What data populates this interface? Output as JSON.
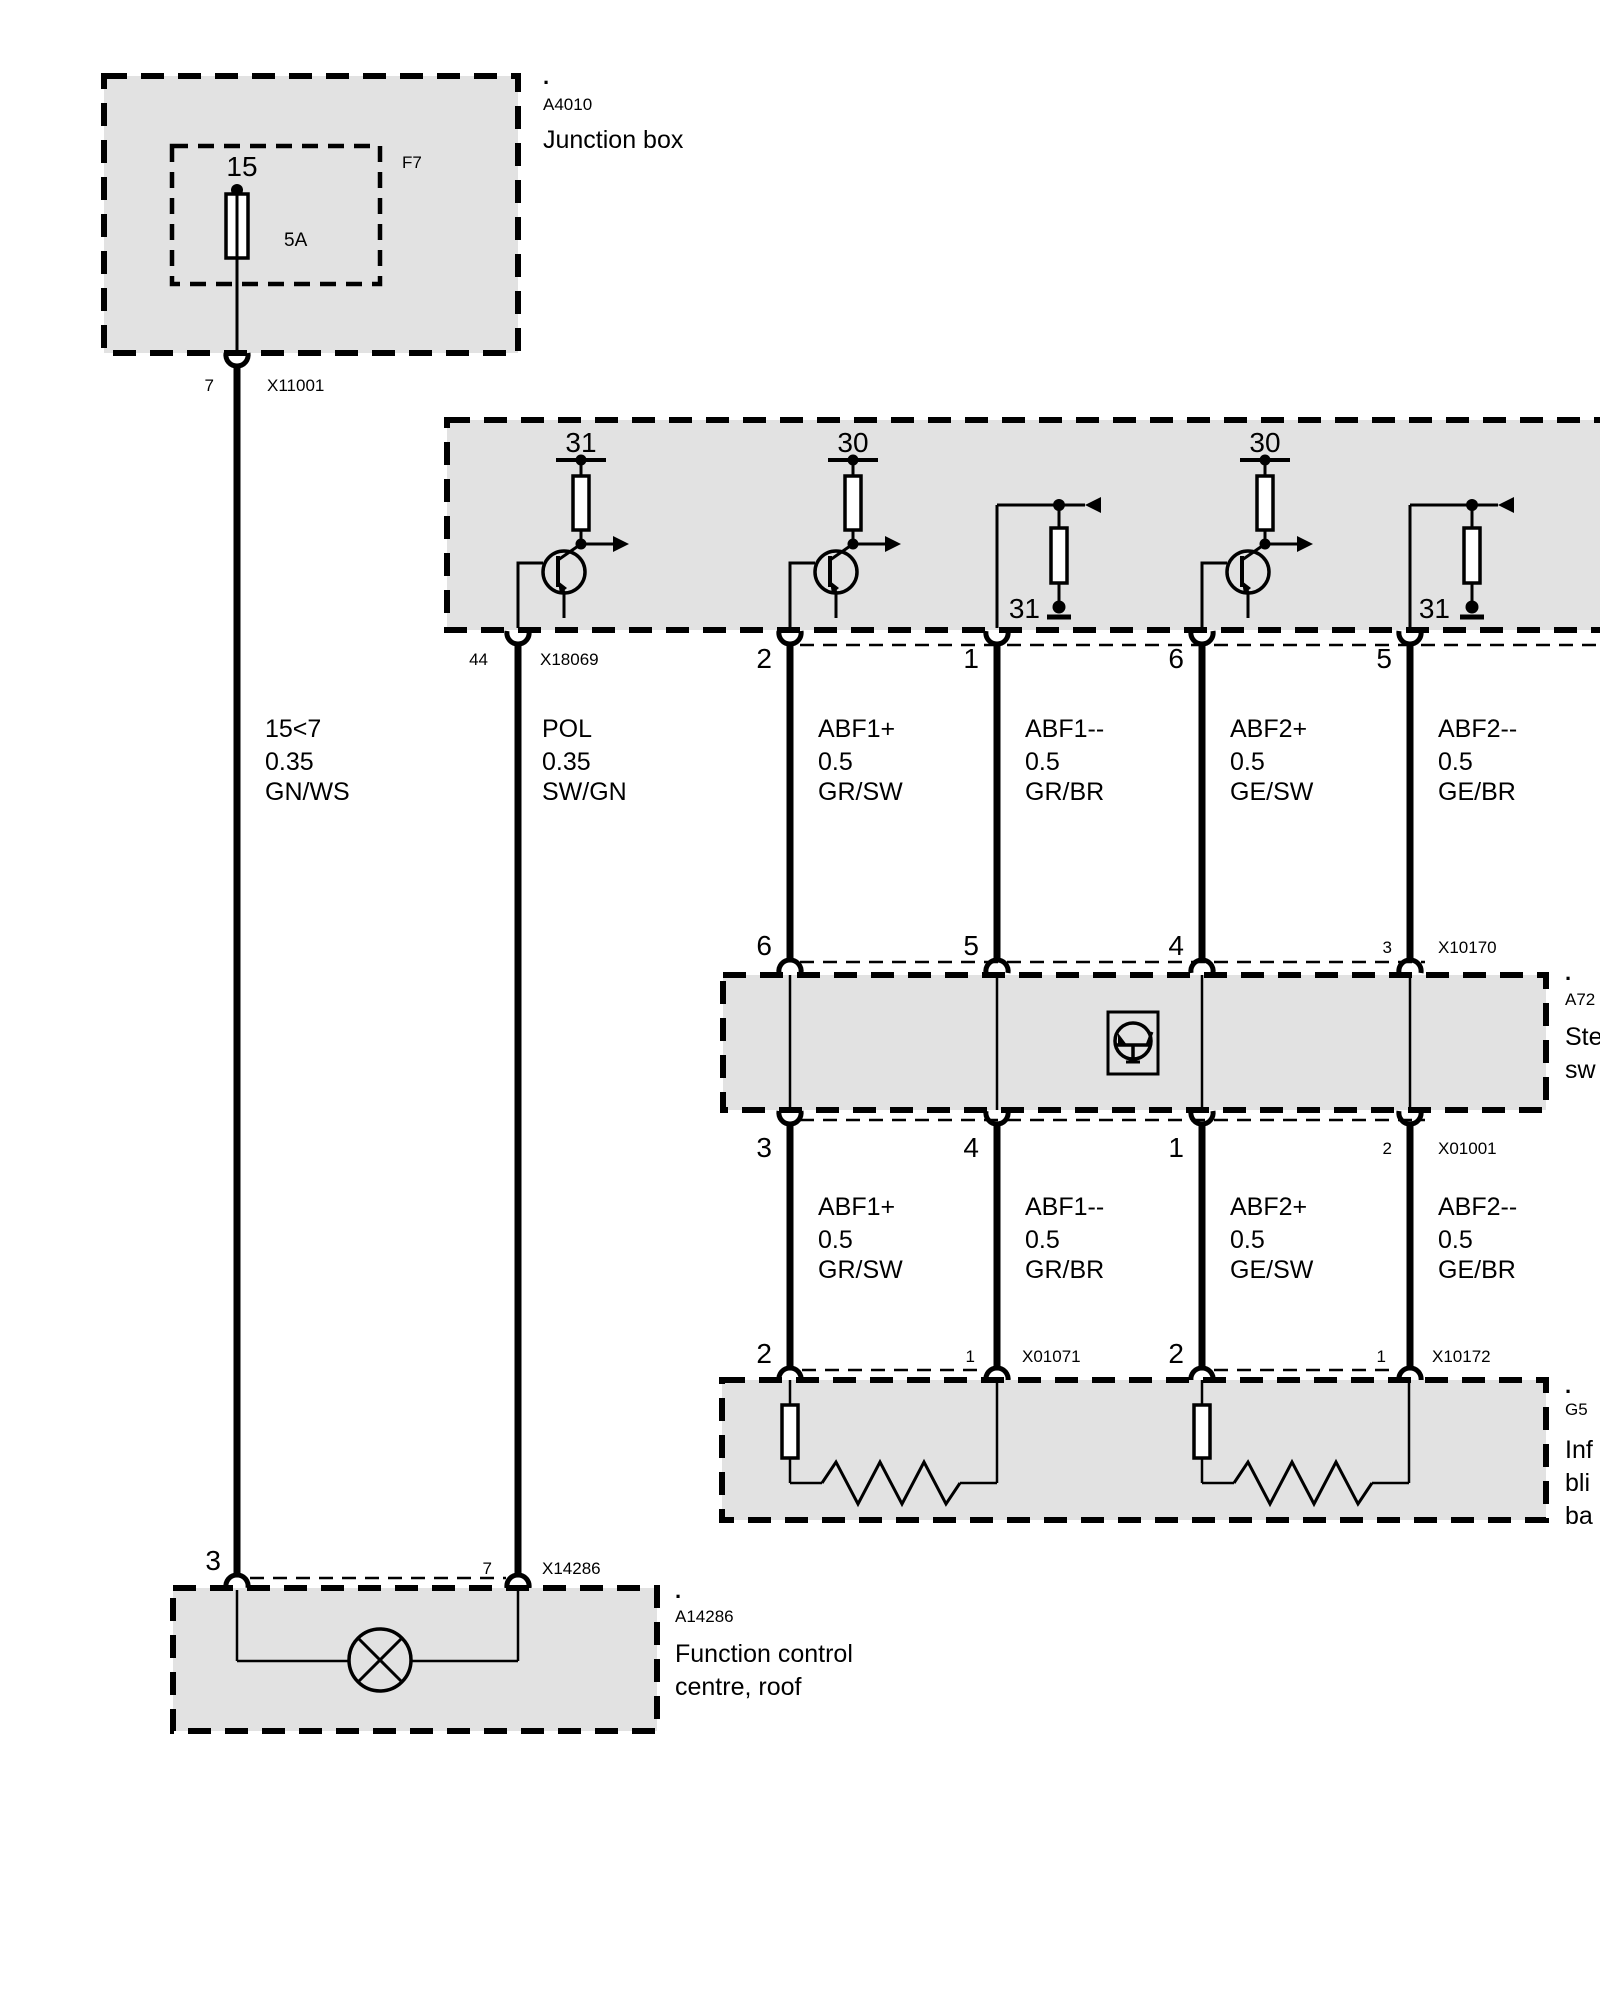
{
  "colors": {
    "box_fill": "#e2e2e2",
    "line": "#000000",
    "background": "#ffffff"
  },
  "junction_box": {
    "dot": ".",
    "ref": "A4010",
    "name": "Junction box",
    "fuse_ref": "F7",
    "fuse_terminal": "15",
    "fuse_rating": "5A",
    "connector": {
      "pin": "7",
      "label": "X11001"
    }
  },
  "control_module": {
    "terminal_g1": "31",
    "terminal_g2": "30",
    "terminal_g4": "30",
    "ground_g3": "31",
    "ground_g5": "31",
    "connector": {
      "pin44": "44",
      "label": "X18069",
      "pin2": "2",
      "pin1": "1",
      "pin6": "6",
      "pin5": "5"
    }
  },
  "wires_upper": [
    {
      "name": "15<7",
      "gauge": "0.35",
      "color": "GN/WS"
    },
    {
      "name": "POL",
      "gauge": "0.35",
      "color": "SW/GN"
    },
    {
      "name": "ABF1+",
      "gauge": "0.5",
      "color": "GR/SW"
    },
    {
      "name": "ABF1--",
      "gauge": "0.5",
      "color": "GR/BR"
    },
    {
      "name": "ABF2+",
      "gauge": "0.5",
      "color": "GE/SW"
    },
    {
      "name": "ABF2--",
      "gauge": "0.5",
      "color": "GE/BR"
    }
  ],
  "wires_lower": [
    {
      "name": "ABF1+",
      "gauge": "0.5",
      "color": "GR/SW"
    },
    {
      "name": "ABF1--",
      "gauge": "0.5",
      "color": "GR/BR"
    },
    {
      "name": "ABF2+",
      "gauge": "0.5",
      "color": "GE/SW"
    },
    {
      "name": "ABF2--",
      "gauge": "0.5",
      "color": "GE/BR"
    }
  ],
  "steering_switch": {
    "dot": ".",
    "ref": "A72",
    "name_line1": "Ste",
    "name_line2": "sw",
    "connector_top": {
      "pin6": "6",
      "pin5": "5",
      "pin4": "4",
      "pin3": "3",
      "label": "X10170"
    },
    "connector_bottom": {
      "pin3": "3",
      "pin4": "4",
      "pin1": "1",
      "pin2": "2",
      "label": "X01001"
    }
  },
  "blind_unit": {
    "dot": ".",
    "ref": "G5",
    "name_line1": "Inf",
    "name_line2": "bli",
    "name_line3": "ba",
    "connector_left": {
      "pin2": "2",
      "pin1": "1",
      "label": "X01071"
    },
    "connector_right": {
      "pin2": "2",
      "pin1": "1",
      "label": "X10172"
    }
  },
  "roof_centre": {
    "dot": ".",
    "ref": "A14286",
    "name_line1": "Function control",
    "name_line2": "centre, roof",
    "connector": {
      "pin3": "3",
      "pin7": "7",
      "label": "X14286"
    }
  }
}
